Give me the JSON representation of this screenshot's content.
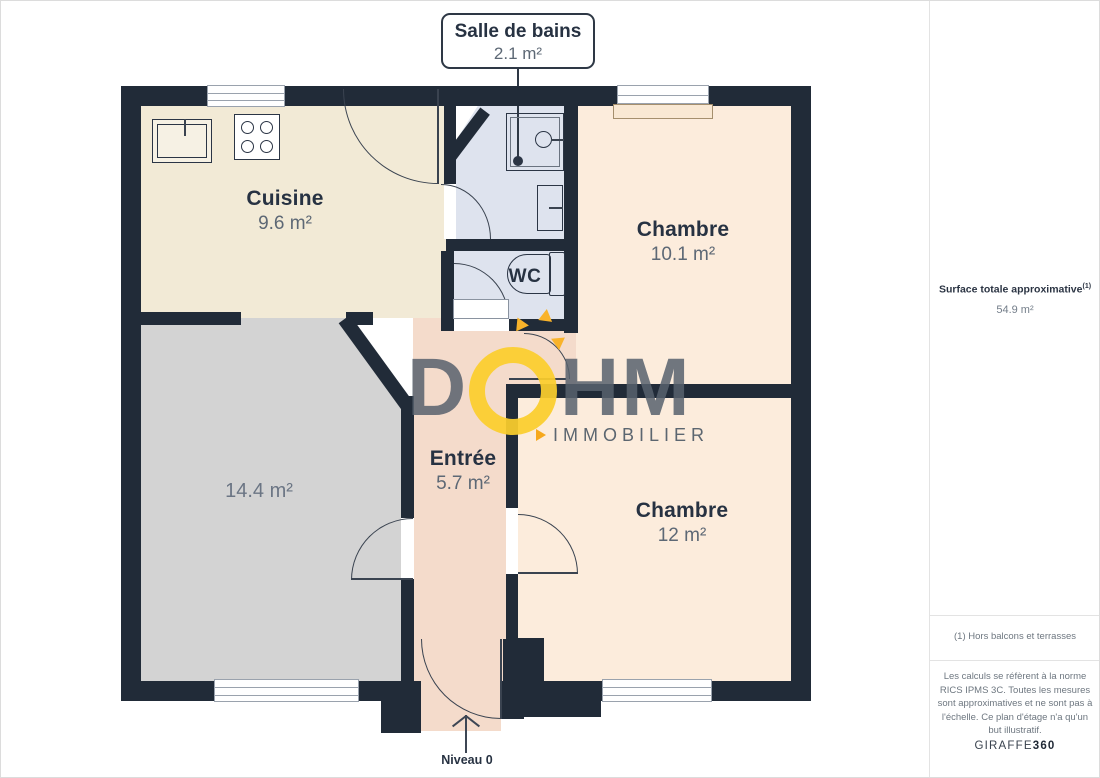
{
  "palette": {
    "wall": "#212b38",
    "kitchen_floor": "#f2ead6",
    "bathroom_floor": "#dee3ee",
    "bedroom_floor": "#fcecdc",
    "entry_floor": "#f4dbcb",
    "living_floor": "#d3d3d3",
    "door_stroke": "#3a4350",
    "label_dark": "#273242",
    "label_gray": "#5d6875",
    "logo_gray": "#58626e",
    "logo_yellow": "#fbcd2c",
    "logo_orange": "#f6a81c"
  },
  "callout": {
    "title": "Salle de bains",
    "area": "2.1 m²"
  },
  "rooms": {
    "cuisine": {
      "name": "Cuisine",
      "area": "9.6 m²"
    },
    "chambre_top": {
      "name": "Chambre",
      "area": "10.1 m²"
    },
    "chambre_bottom": {
      "name": "Chambre",
      "area": "12 m²"
    },
    "entree": {
      "name": "Entrée",
      "area": "5.7 m²"
    },
    "living": {
      "area": "14.4 m²"
    },
    "wc": {
      "name": "WC"
    }
  },
  "watermark": {
    "letter_d": "D",
    "letters_hm": "HM",
    "subtitle": "IMMOBILIER"
  },
  "footer": {
    "level_label": "Niveau 0"
  },
  "sidebar": {
    "title": "Surface totale approximative",
    "title_superscript": "(1)",
    "total_area": "54.9 m²",
    "footnote": "(1) Hors balcons et terrasses",
    "disclaimer": "Les calculs se réfèrent à la norme RICS IPMS 3C. Toutes les mesures sont approximatives et ne sont pas à l'échelle. Ce plan d'étage n'a qu'un but illustratif.",
    "brand": "GIRAFFE",
    "brand_bold": "360"
  }
}
